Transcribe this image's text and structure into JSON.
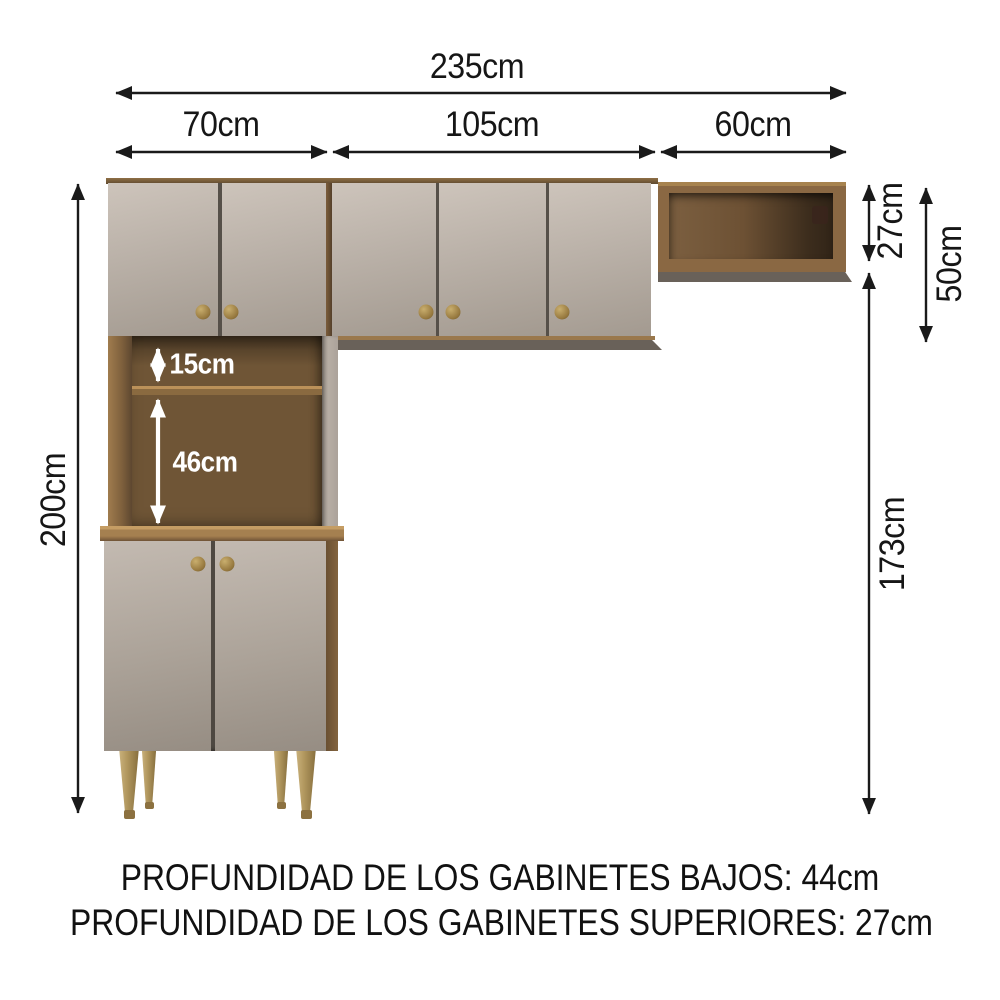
{
  "dims": {
    "total_width": "235cm",
    "left_width": "70cm",
    "center_width": "105cm",
    "right_width": "60cm",
    "total_height": "200cm",
    "shelf_height": "27cm",
    "upper_height": "50cm",
    "clearance_height": "173cm",
    "niche_upper": "15cm",
    "niche_lower": "46cm"
  },
  "notes": {
    "depth_lower": "PROFUNDIDAD DE LOS GABINETES BAJOS: 44cm",
    "depth_upper": "PROFUNDIDAD DE LOS GABINETES SUPERIORES: 27cm"
  },
  "colors": {
    "door": "#b4aba1",
    "wood_frame": "#8a6843",
    "wood_interior": "#6f5536",
    "knob": "#a3834a",
    "leg": "#b2985f",
    "arrow": "#1a1a1a",
    "inner_label": "#ffffff",
    "background": "#ffffff"
  }
}
